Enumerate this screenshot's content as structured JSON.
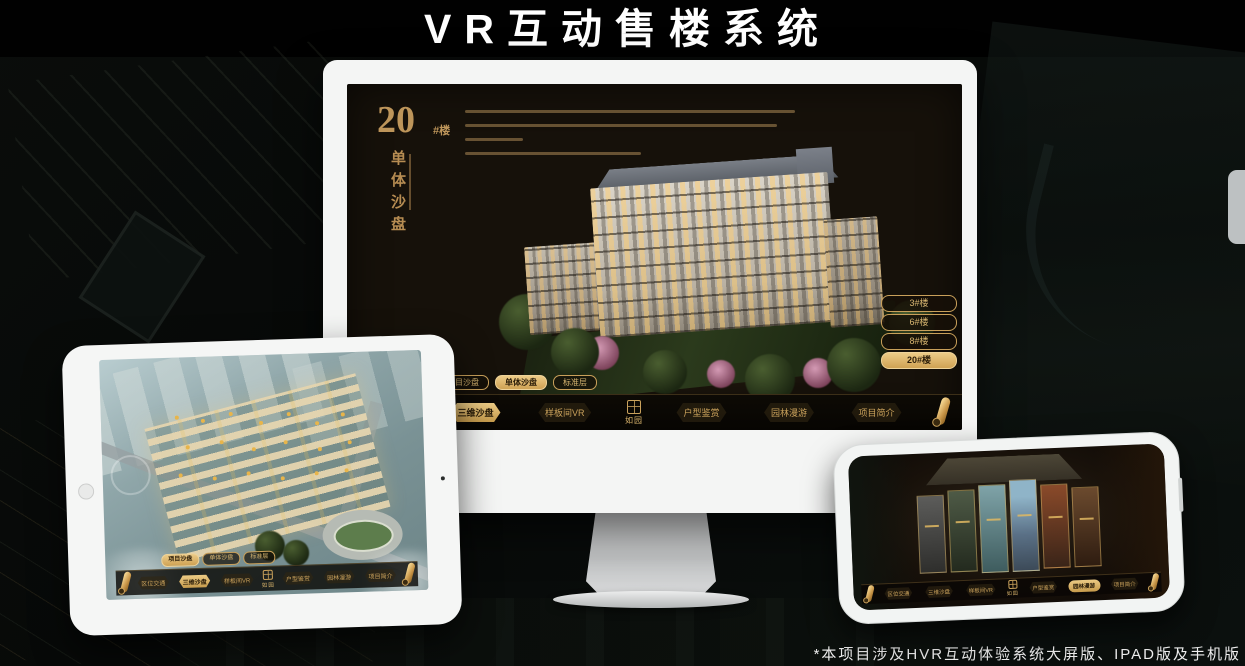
{
  "page": {
    "title": "VR互动售楼系统",
    "footnote": "*本项目涉及HVR互动体验系统大屏版、IPAD版及手机版"
  },
  "brand": {
    "logo": "如园"
  },
  "colors": {
    "gold": "#c9a05a",
    "gold_bright": "#eccb87",
    "screen_bg": "#16110a",
    "title_color": "#ffffff"
  },
  "monitor": {
    "heading": {
      "number": "20",
      "suffix": "#楼",
      "subtitle": "单体沙盘"
    },
    "floor_buttons": [
      {
        "label": "3#楼",
        "active": false
      },
      {
        "label": "6#楼",
        "active": false
      },
      {
        "label": "8#楼",
        "active": false
      },
      {
        "label": "20#楼",
        "active": true
      }
    ],
    "tabs": [
      {
        "label": "项目沙盘",
        "active": false
      },
      {
        "label": "单体沙盘",
        "active": true
      },
      {
        "label": "标准层",
        "active": false
      }
    ],
    "nav_items": [
      "区位交通",
      "三维沙盘",
      "样板间VR",
      "户型鉴赏",
      "园林漫游",
      "项目简介"
    ],
    "active_nav": "三维沙盘"
  },
  "tablet": {
    "tabs": [
      {
        "label": "项目沙盘",
        "active": true
      },
      {
        "label": "单体沙盘",
        "active": false
      },
      {
        "label": "标准层",
        "active": false
      }
    ],
    "nav_items": [
      "区位交通",
      "三维沙盘",
      "样板间VR",
      "户型鉴赏",
      "园林漫游",
      "项目简介"
    ],
    "active_nav": "三维沙盘"
  },
  "phone": {
    "nav_items": [
      "区位交通",
      "三维沙盘",
      "样板间VR",
      "户型鉴赏",
      "园林漫游",
      "项目简介"
    ],
    "active_nav": "园林漫游"
  }
}
